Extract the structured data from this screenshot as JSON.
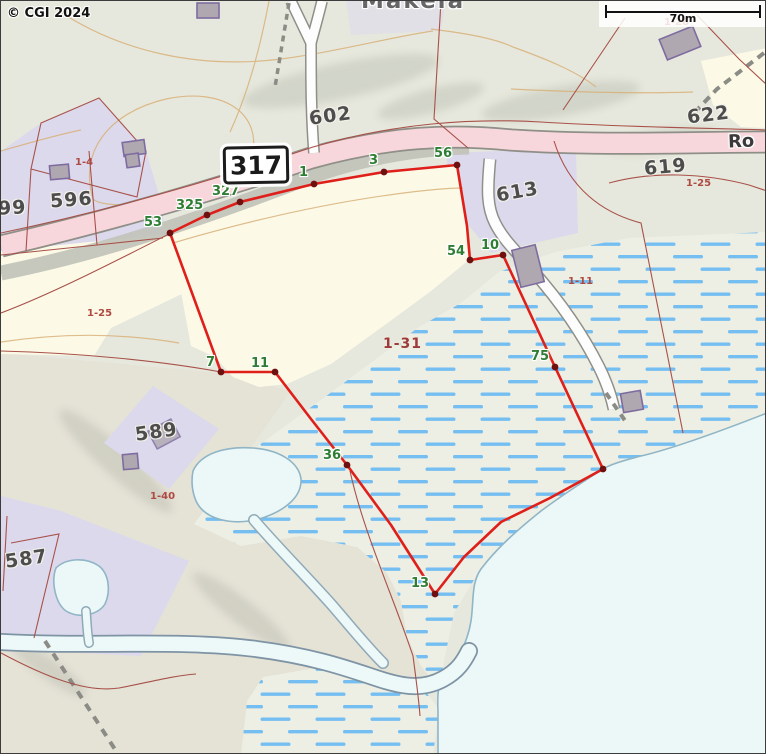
{
  "map": {
    "copyright": "© CGI 2024",
    "scale_bar": {
      "distance_label": "70m"
    },
    "road_sign": {
      "number": "317"
    },
    "road_name_partial": "Ro",
    "place_name": "Mäkelä",
    "area_label": "1-31",
    "parcel_labels": [
      {
        "text": "596"
      },
      {
        "text": "99"
      },
      {
        "text": "602"
      },
      {
        "text": "613"
      },
      {
        "text": "619"
      },
      {
        "text": "622"
      },
      {
        "text": "589"
      },
      {
        "text": "587"
      }
    ],
    "unit_labels": [
      {
        "text": "1-4"
      },
      {
        "text": "1-28"
      },
      {
        "text": "1-25"
      },
      {
        "text": "1-25"
      },
      {
        "text": "1-11"
      },
      {
        "text": "1-40"
      }
    ],
    "boundary_vertices": [
      {
        "label": "53"
      },
      {
        "label": "325"
      },
      {
        "label": "327"
      },
      {
        "label": "1"
      },
      {
        "label": "3"
      },
      {
        "label": "56"
      },
      {
        "label": "54"
      },
      {
        "label": "10"
      },
      {
        "label": "75"
      },
      {
        "label": "13"
      },
      {
        "label": "36"
      },
      {
        "label": "11"
      },
      {
        "label": "7"
      }
    ],
    "colors": {
      "boundary_red": "#DF1F1A",
      "vertex_dot": "#6E0F10",
      "vertex_label_green": "#2E7D32",
      "parcel_label_gray": "#4D4D4D",
      "unit_label_red": "#AF4A42",
      "marsh_dash_blue": "#74BEF2",
      "road_pink": "#F7D7DC",
      "water_pale": "#EDF9F8",
      "field_cream": "#FCFAE7",
      "residential_lavender": "#DCD9ED"
    }
  }
}
